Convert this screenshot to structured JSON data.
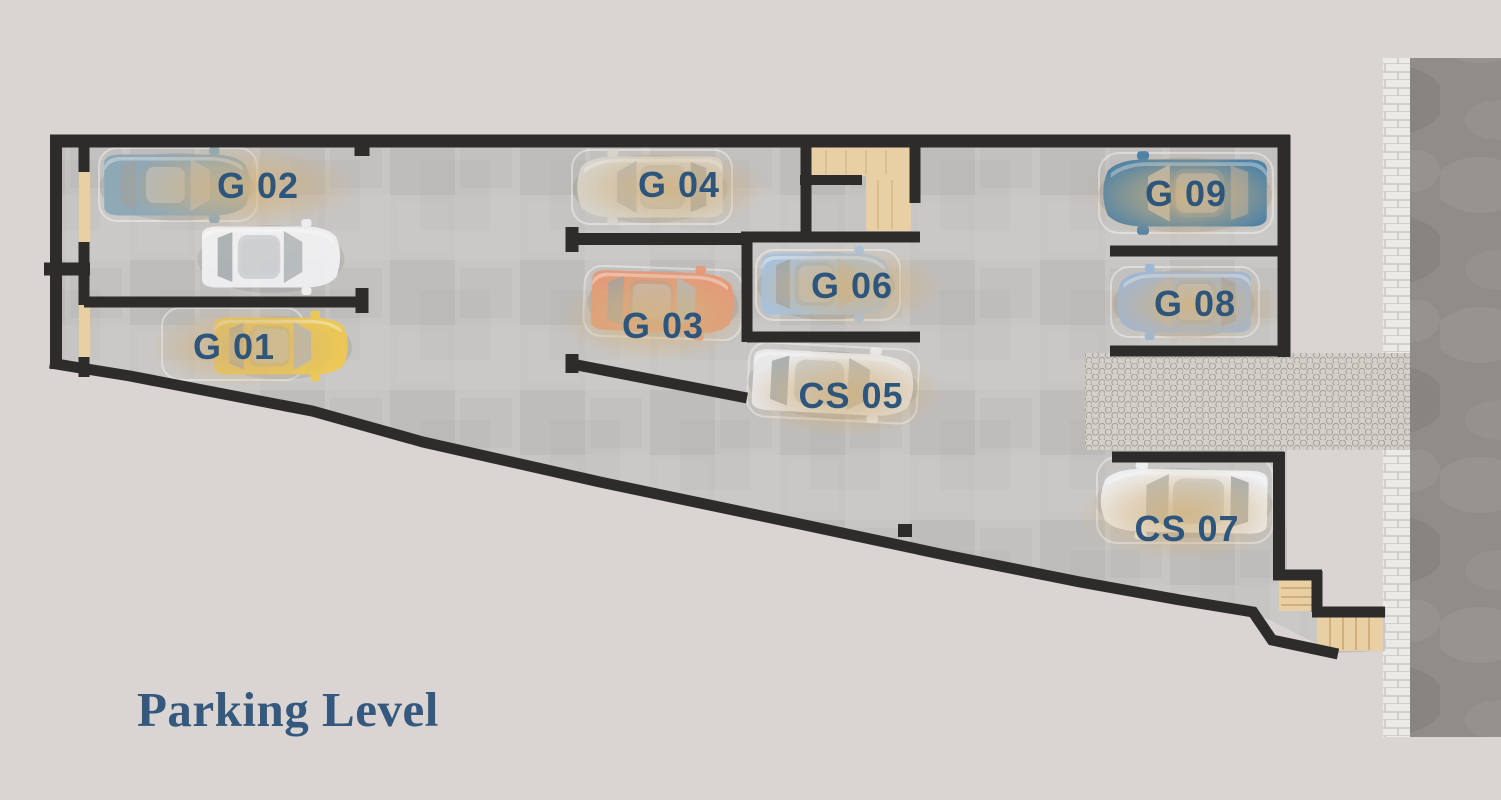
{
  "title": {
    "text": "Parking Level",
    "color": "#35597e"
  },
  "colors": {
    "background": "#dad5d2",
    "floor": "#c8c6c4",
    "wall": "#2e2c2a",
    "road": "#8f8c89",
    "sidewalk": "#eceae6",
    "cobblestone": "#d3d0cb",
    "stairs": "#e9cfa4",
    "label_text": "#2e567c",
    "glow": "#d2b27e",
    "spot_outline": "#ffffff"
  },
  "spots": {
    "g01": {
      "label": "G 01",
      "car_color": "#ecc854"
    },
    "g02": {
      "label": "G 02",
      "car_color": "#8da8b6"
    },
    "g03": {
      "label": "G 03",
      "car_color": "#e69a78"
    },
    "g04": {
      "label": "G 04",
      "car_color": "#d8d5cd"
    },
    "cs05": {
      "label": "CS 05",
      "car_color": "#e9e9eb"
    },
    "g06": {
      "label": "G 06",
      "car_color": "#a9c2da"
    },
    "cs07": {
      "label": "CS 07",
      "car_color": "#eff0f2"
    },
    "g08": {
      "label": "G 08",
      "car_color": "#9fb6d6"
    },
    "g09": {
      "label": "G 09",
      "car_color": "#4b80a6"
    }
  },
  "extra_car": {
    "car_color": "#efeff1"
  }
}
